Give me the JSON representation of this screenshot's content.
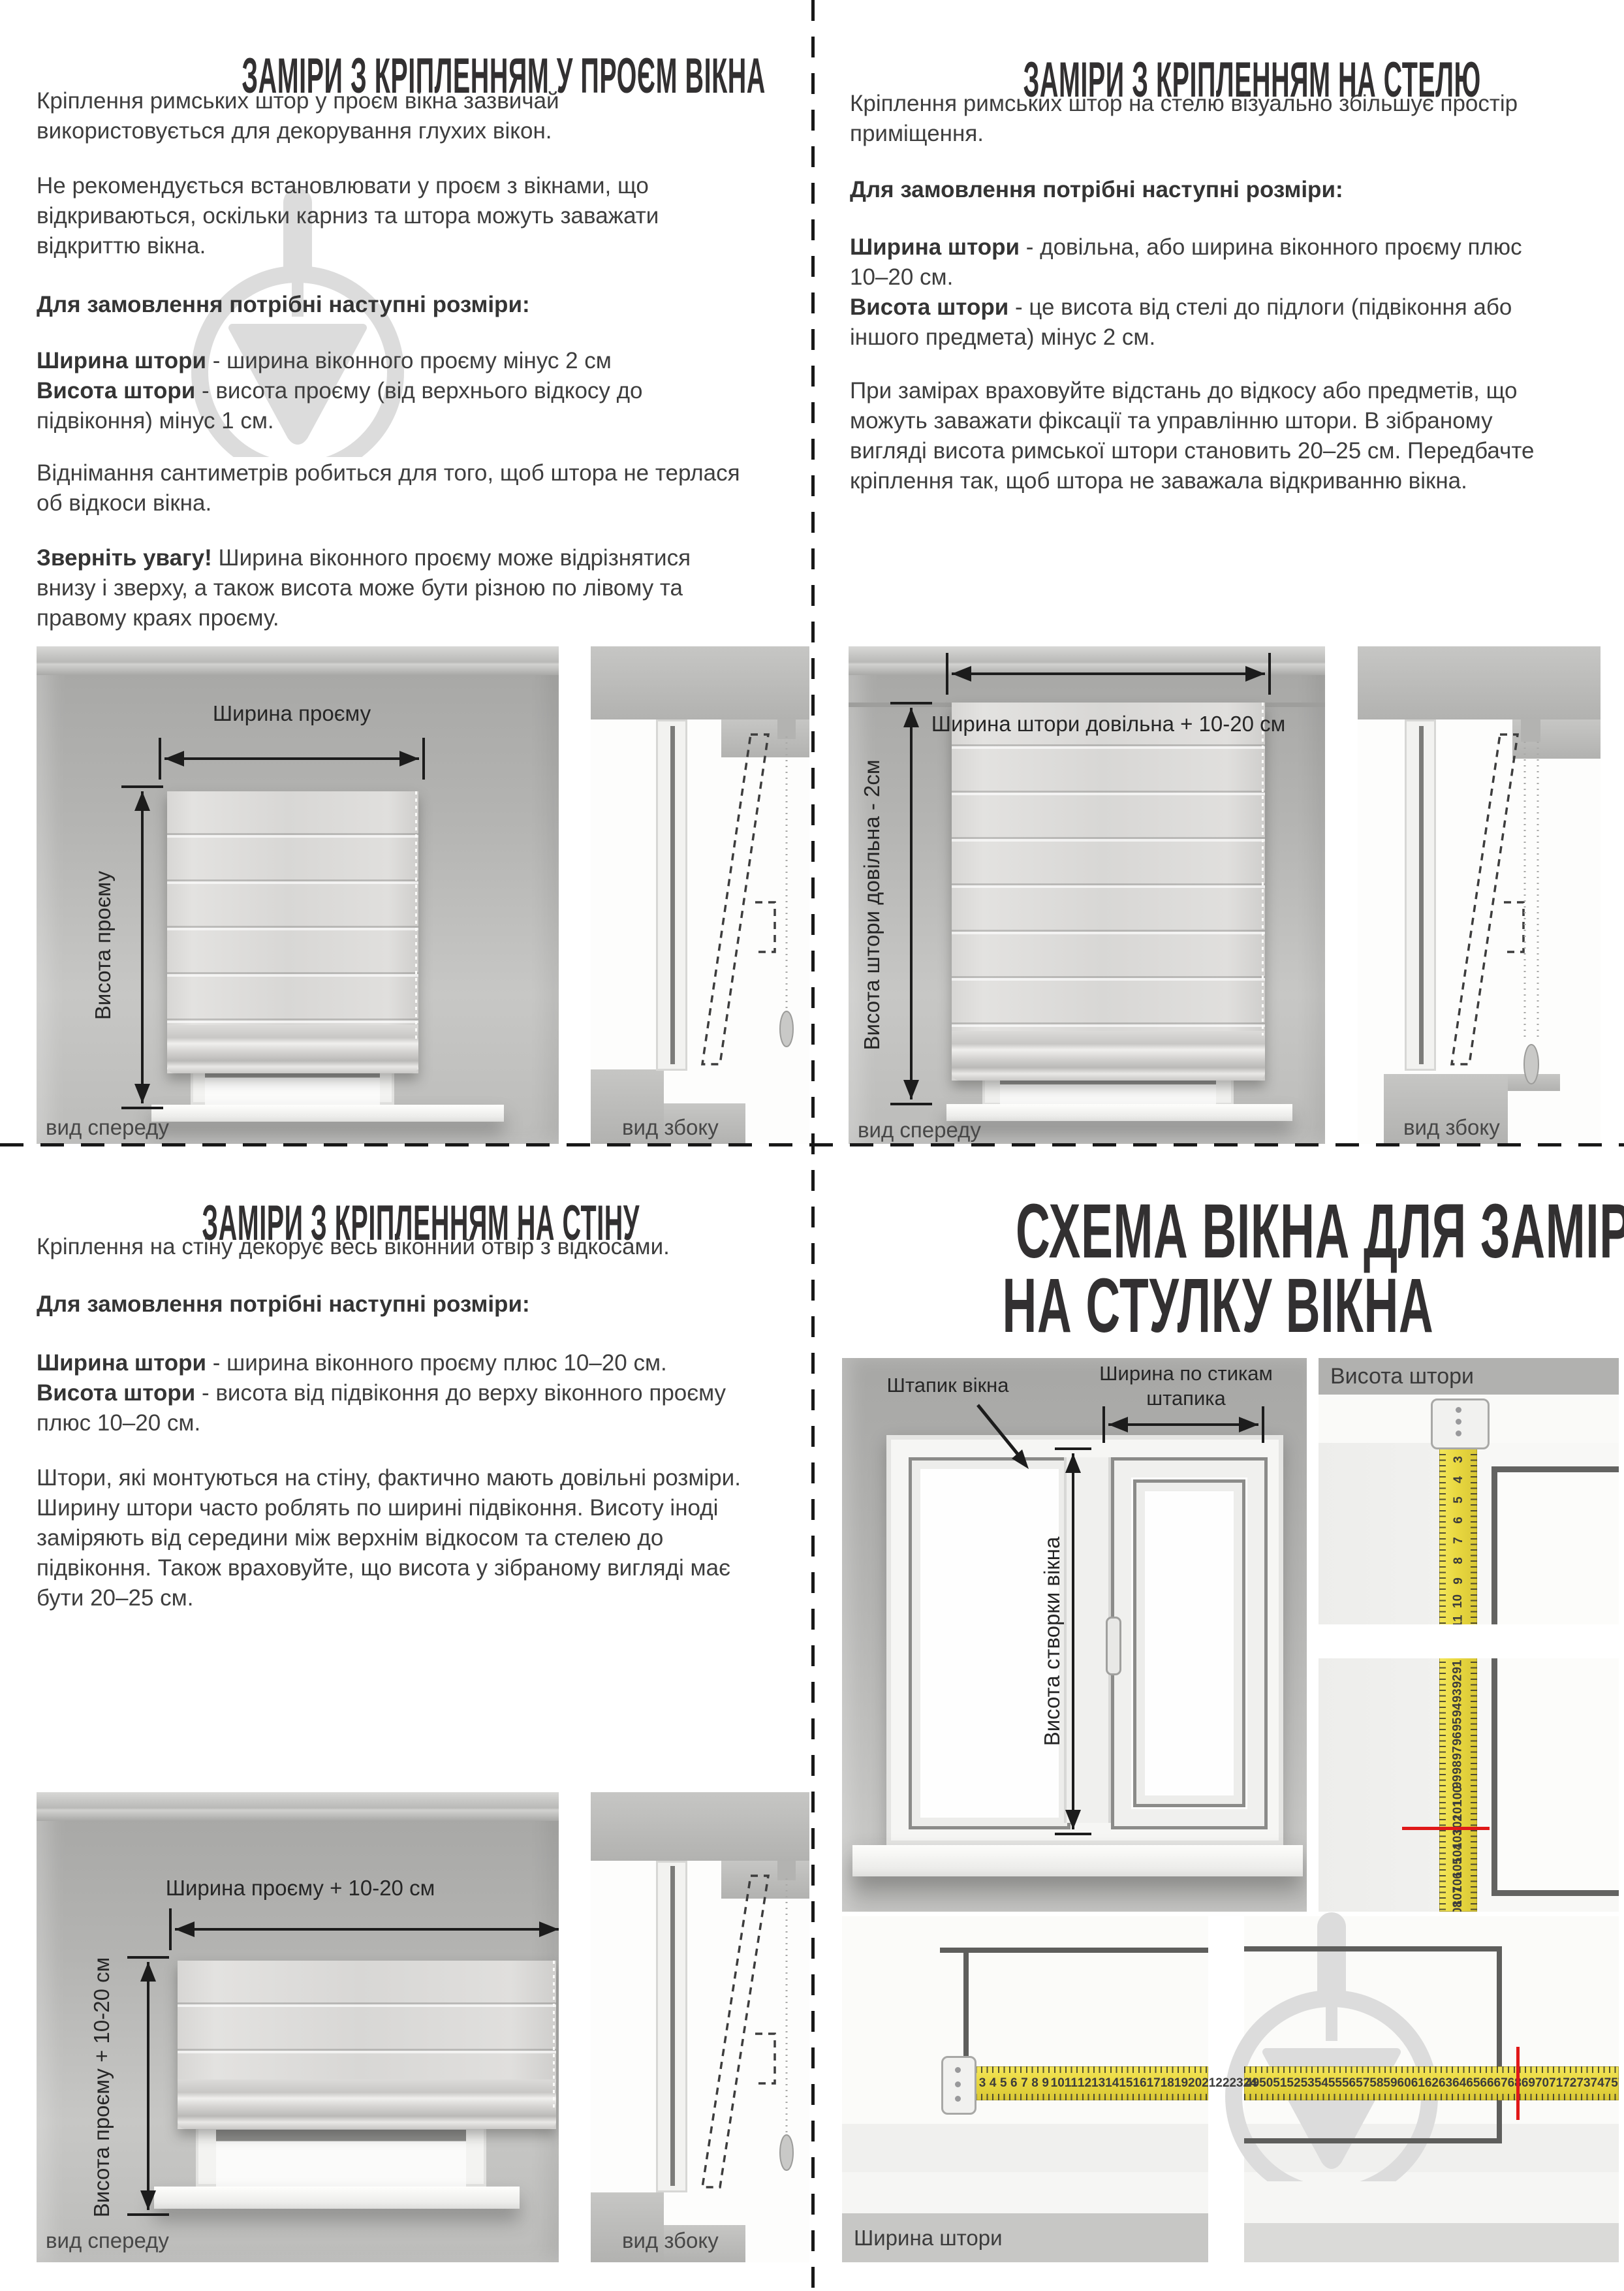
{
  "colors": {
    "tape_yellow": "#e9d840",
    "red_mark": "#e01818",
    "text": "#3e3e3e",
    "title": "#323031",
    "watermark": "#dcdcdc"
  },
  "opening": {
    "title": "ЗАМІРИ З КРІПЛЕННЯМ У ПРОЄМ ВІКНА",
    "p1": "Кріплення римських штор у проєм вікна зазвичай використовується для декорування глухих вікон.",
    "p2": "Не рекомендується встановлювати у проєм з вікнами, що відкриваються, оскільки карниз та штора можуть заважати відкриттю вікна.",
    "order_heading": "Для замовлення потрібні наступні розміри:",
    "width_term": "Ширина штори",
    "width_def": " - ширина віконного проєму мінус 2 см",
    "height_term": "Висота штори",
    "height_def": " - висота проєму (від верхнього відкосу до підвіконня) мінус 1 см.",
    "p3": "Віднімання сантиметрів робиться для того, щоб штора не терлася об відкоси вікна.",
    "note_term": "Зверніть увагу!",
    "note_rest": " Ширина віконного проєму може відрізнятися внизу і зверху, а також висота може бути різною по лівому та правому краях проєму.",
    "fig_width": "Ширина проєму",
    "fig_height": "Висота проєму",
    "cap_front": "вид спереду",
    "cap_side": "вид збоку"
  },
  "ceiling": {
    "title": "ЗАМІРИ З КРІПЛЕННЯМ НА СТЕЛЮ",
    "p1": "Кріплення римських штор на стелю візуально збільшує простір приміщення.",
    "order_heading": "Для замовлення потрібні наступні розміри:",
    "width_term": "Ширина штори",
    "width_def": " - довільна, або ширина віконного проєму плюс 10–20 см.",
    "height_term": "Висота штори",
    "height_def": " - це висота від стелі до підлоги (підвіконня або іншого предмета) мінус 2 см.",
    "p2": "При замірах враховуйте відстань до відкосу або предметів, що можуть заважати фіксації та управлінню штори. В зібраному вигляді висота римської штори становить 20–25 см. Передбачте кріплення так, щоб штора не заважала відкриванню вікна.",
    "fig_width": "Ширина штори довільна + 10-20 см",
    "fig_height": "Висота штори довільна - 2см",
    "cap_front": "вид спереду",
    "cap_side": "вид збоку"
  },
  "wall": {
    "title": "ЗАМІРИ З КРІПЛЕННЯМ НА СТІНУ",
    "p1": "Кріплення на стіну декорує весь віконний отвір з відкосами.",
    "order_heading": "Для замовлення потрібні наступні розміри:",
    "width_term": "Ширина штори",
    "width_def": " - ширина віконного проєму плюс 10–20 см.",
    "height_term": "Висота штори",
    "height_def": " - висота від підвіконня до верху віконного проєму плюс 10–20 см.",
    "p2": "Штори, які монтуються на стіну, фактично мають довільні розміри. Ширину штори часто роблять по ширині підвіконня. Висоту іноді заміряють від середини між верхнім відкосом та стелею до підвіконня. Також враховуйте, що висота у зібраному вигляді має бути 20–25 см.",
    "fig_width": "Ширина проєму + 10-20 см",
    "fig_height": "Висота проєму + 10-20 см",
    "cap_front": "вид спереду",
    "cap_side": "вид збоку"
  },
  "sash": {
    "title_l1": "СХЕМА ВІКНА ДЛЯ ЗАМІРІВ",
    "title_l2": "НА СТУЛКУ ВІКНА",
    "label_bead": "Штапик вікна",
    "label_bead_width_l1": "Ширина по стикам",
    "label_bead_width_l2": "штапика",
    "label_sash_height": "Висота створки вікна",
    "label_height": "Висота штори",
    "label_width": "Ширина штори",
    "tape_v_top": [
      3,
      4,
      5,
      6,
      7,
      8,
      9,
      10,
      11
    ],
    "tape_v_bottom": [
      91,
      92,
      93,
      94,
      95,
      96,
      97,
      98,
      99,
      100,
      101,
      102,
      103,
      104,
      105,
      106,
      107,
      108,
      109,
      110
    ],
    "tape_v_red_at": 104,
    "tape_h_left": [
      3,
      4,
      5,
      6,
      7,
      8,
      9,
      10,
      11,
      12,
      13,
      14,
      15,
      16,
      17,
      18,
      19,
      20,
      21,
      22,
      23,
      24
    ],
    "tape_h_right": [
      49,
      50,
      51,
      52,
      53,
      54,
      55,
      56,
      57,
      58,
      59,
      60,
      61,
      62,
      63,
      64,
      65,
      66,
      67,
      68,
      69,
      70,
      71,
      72,
      73,
      74,
      75,
      76,
      77,
      78,
      79
    ],
    "tape_h_red_at": 73
  }
}
